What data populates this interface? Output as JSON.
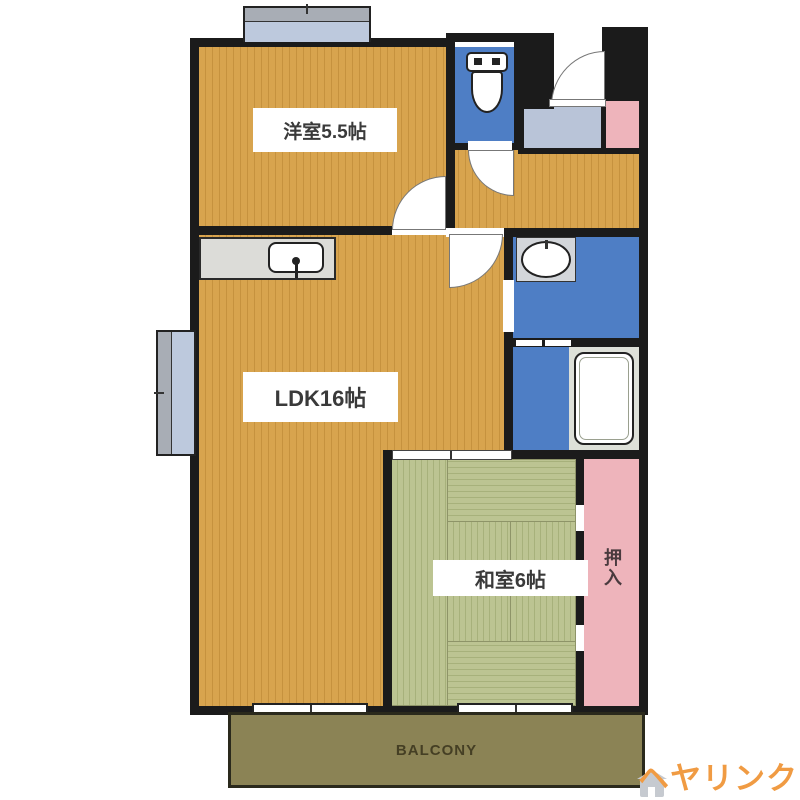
{
  "floor_plan": {
    "western_room_label": "洋室5.5帖",
    "ldk_label": "LDK16帖",
    "japanese_room_label": "和室6帖",
    "closet_label": "押入",
    "balcony_label": "BALCONY"
  },
  "watermark": {
    "text": "ヘヤリンク"
  },
  "colors": {
    "wall": "#1b1b1b",
    "wood_floor": "#d8a44e",
    "wood_stripe": "#c6923e",
    "wet_area_blue": "#4e7ec5",
    "tatami_green": "#bcc492",
    "tatami_stripe": "#a7b17b",
    "closet_pink": "#eeb4bb",
    "entrance_blue_gray": "#b9c4d8",
    "window_blue": "#bdc9dd",
    "window_gray": "#a8adb5",
    "counter_gray": "#dcdcd8",
    "balcony_olive": "#8b8355",
    "balcony_text": "#453f24",
    "watermark_orange": "#f09b43"
  }
}
